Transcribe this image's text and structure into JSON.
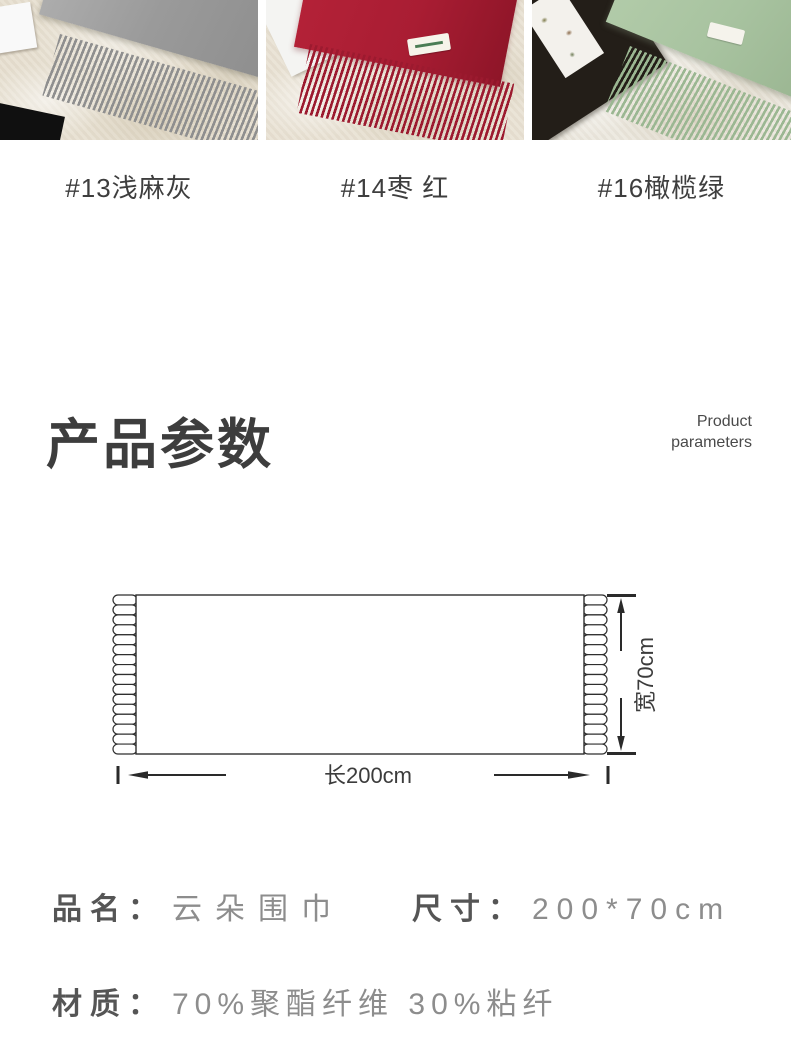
{
  "products": [
    {
      "label": "#13浅麻灰",
      "scarf_color": "#9a9a9a"
    },
    {
      "label": "#14枣 红",
      "scarf_color": "#a91d33"
    },
    {
      "label": "#16橄榄绿",
      "scarf_color": "#a8c3a0"
    }
  ],
  "params_header": {
    "title_cn": "产品参数",
    "title_en_line1": "Product",
    "title_en_line2": "parameters"
  },
  "diagram": {
    "length_label": "长200cm",
    "width_label": "宽70cm"
  },
  "specs": {
    "name_label": "品名：",
    "name_value": "云朵围巾",
    "size_label": "尺寸：",
    "size_value": "200*70cm",
    "material_label": "材质：",
    "material_value": "70%聚酯纤维 30%粘纤"
  }
}
